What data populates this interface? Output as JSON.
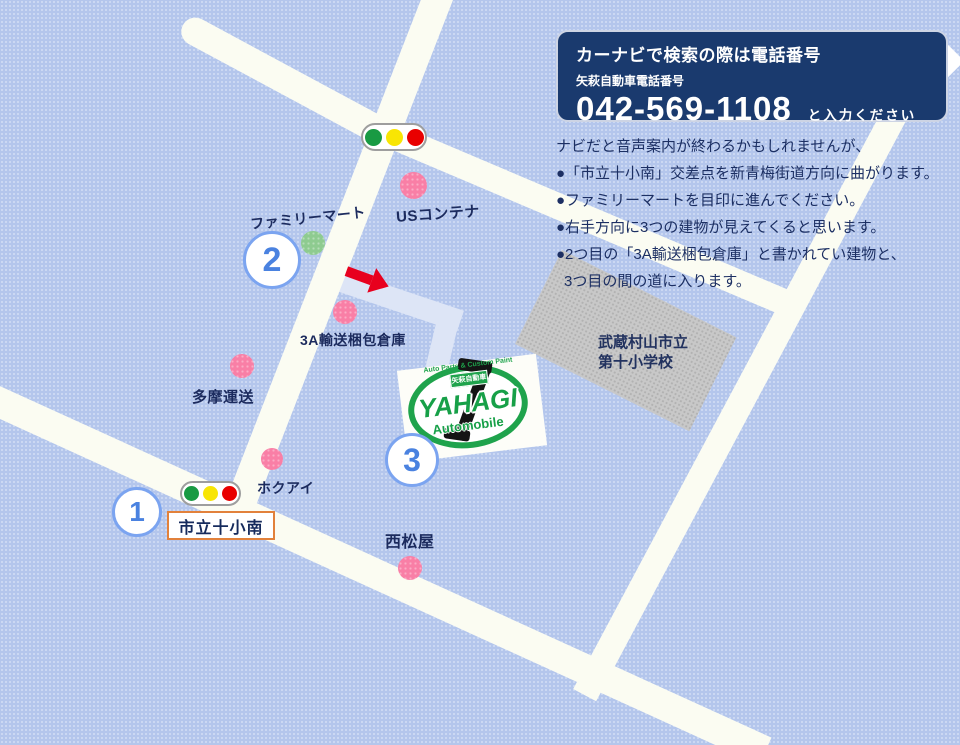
{
  "phone_box": {
    "title": "カーナビで検索の際は電話番号",
    "company_label": "矢萩自動車電話番号",
    "phone": "042-569-1108",
    "suffix": "と入力ください"
  },
  "directions": {
    "lines": [
      "ナビだと音声案内が終わるかもしれませんが、",
      "●「市立十小南」交差点を新青梅街道方向に曲がります。",
      "●ファミリーマートを目印に進んでください。",
      "●右手方向に3つの建物が見えてくると思います。",
      "●2つ目の「3A輸送梱包倉庫」と書かれてい建物と、",
      "3つ目の間の道に入ります。"
    ]
  },
  "landmarks": [
    {
      "label": "USコンテナ",
      "marker": "pink-dot"
    },
    {
      "label": "ファミリーマート",
      "marker": "green-dot"
    },
    {
      "label": "3A輸送梱包倉庫",
      "marker": "pink-dot"
    },
    {
      "label": "多摩運送",
      "marker": "pink-dot"
    },
    {
      "label": "ホクアイ",
      "marker": "pink-dot"
    },
    {
      "label": "西松屋",
      "marker": "pink-dot"
    }
  ],
  "school": {
    "line1": "武蔵村山市立",
    "line2": "第十小学校"
  },
  "intersection_sign": {
    "label": "市立十小南"
  },
  "route_markers": [
    {
      "number": "1"
    },
    {
      "number": "2"
    },
    {
      "number": "3"
    }
  ],
  "logo": {
    "arc_text": "Auto Parts & Custom Paint",
    "badge": "矢萩自動車",
    "name": "YAHAGI",
    "subtitle": "Automobile"
  },
  "colors": {
    "background": "#b4c6ec",
    "road": "#fbfcf2",
    "entry_road": "#dde5f6",
    "phone_box_bg": "#1a3a6e",
    "text_navy": "#1c2f63",
    "landmark_pink": "#f97fa6",
    "landmark_green": "#8ecb90",
    "traffic_green": "#199a43",
    "traffic_yellow": "#f8e504",
    "traffic_red": "#e90000",
    "marker_blue": "#4a82e0",
    "arrow_red": "#e8001e",
    "brand_green": "#1fa34c",
    "sign_border_orange": "#e2813b",
    "school_gray": "#c8c8c8"
  }
}
